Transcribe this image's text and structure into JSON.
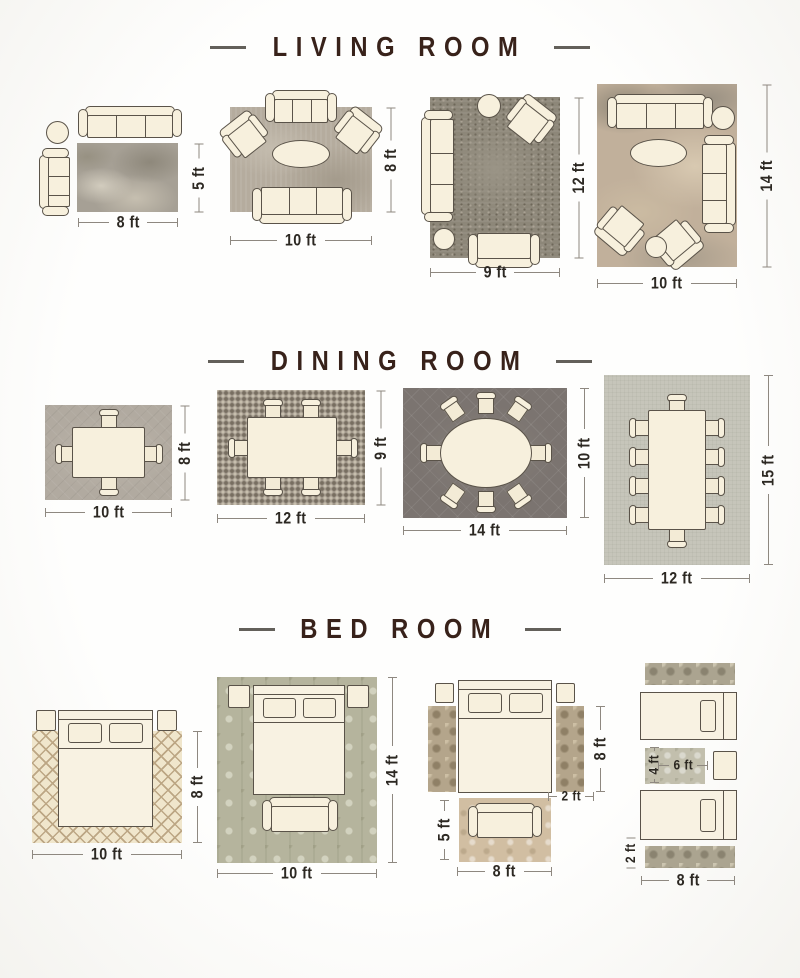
{
  "colors": {
    "title": "#38221a",
    "furniture_fill": "#f7f0dd",
    "outline": "#5a5349",
    "dim_text": "#2c2822",
    "dim_line": "#8e8880"
  },
  "sections": [
    {
      "title": "LIVING ROOM",
      "layouts": [
        {
          "name": "sofa-corner",
          "w": "8 ft",
          "h": "5 ft"
        },
        {
          "name": "symmetric-seating",
          "w": "10 ft",
          "h": "8 ft"
        },
        {
          "name": "l-shape-seating",
          "w": "9 ft",
          "h": "12 ft"
        },
        {
          "name": "full-seating",
          "w": "10 ft",
          "h": "14 ft"
        }
      ]
    },
    {
      "title": "DINING ROOM",
      "layouts": [
        {
          "name": "four-seat-table",
          "w": "10 ft",
          "h": "8 ft"
        },
        {
          "name": "six-seat-table",
          "w": "12 ft",
          "h": "9 ft"
        },
        {
          "name": "oval-eight-seat-table",
          "w": "14 ft",
          "h": "10 ft"
        },
        {
          "name": "ten-seat-table",
          "w": "12 ft",
          "h": "15 ft"
        }
      ]
    },
    {
      "title": "BED ROOM",
      "layouts": [
        {
          "name": "queen-bed",
          "w": "10 ft",
          "h": "8 ft"
        },
        {
          "name": "king-bed",
          "w": "10 ft",
          "h": "14 ft"
        },
        {
          "name": "bed-with-runners",
          "runner_h": "8 ft",
          "runner_w": "2 ft",
          "rug_h": "5 ft",
          "rug_w": "8 ft"
        },
        {
          "name": "twin-beds",
          "rug_h": "4 ft",
          "rug_w": "6 ft",
          "runner_h": "2 ft",
          "runner_w": "8 ft"
        }
      ]
    }
  ]
}
